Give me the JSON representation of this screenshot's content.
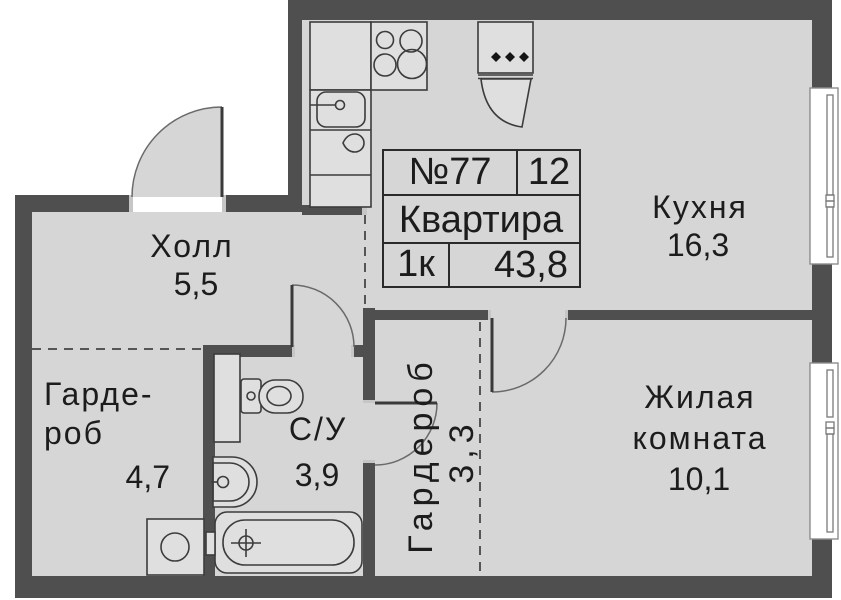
{
  "plan": {
    "title_block": {
      "apartment_number": "№77",
      "position_number": "12",
      "type_label": "Квартира",
      "rooms_count": "1к",
      "total_area": "43,8"
    },
    "rooms": {
      "hall": {
        "name": "Холл",
        "area": "5,5"
      },
      "kitchen": {
        "name": "Кухня",
        "area": "16,3"
      },
      "wardrobe_left": {
        "name_line1": "Гарде-",
        "name_line2": "роб",
        "area": "4,7"
      },
      "bathroom": {
        "name": "С/У",
        "area": "3,9"
      },
      "wardrobe_center": {
        "name": "Гардероб",
        "area": "3,3"
      },
      "living_room": {
        "name_line1": "Жилая",
        "name_line2": "комната",
        "area": "10,1"
      }
    },
    "colors": {
      "wall": "#4f4f4f",
      "floor": "#d6d6d6",
      "fixture": "#dfdfdf",
      "outline": "#3c3c3c",
      "text": "#1c1c1c"
    }
  }
}
